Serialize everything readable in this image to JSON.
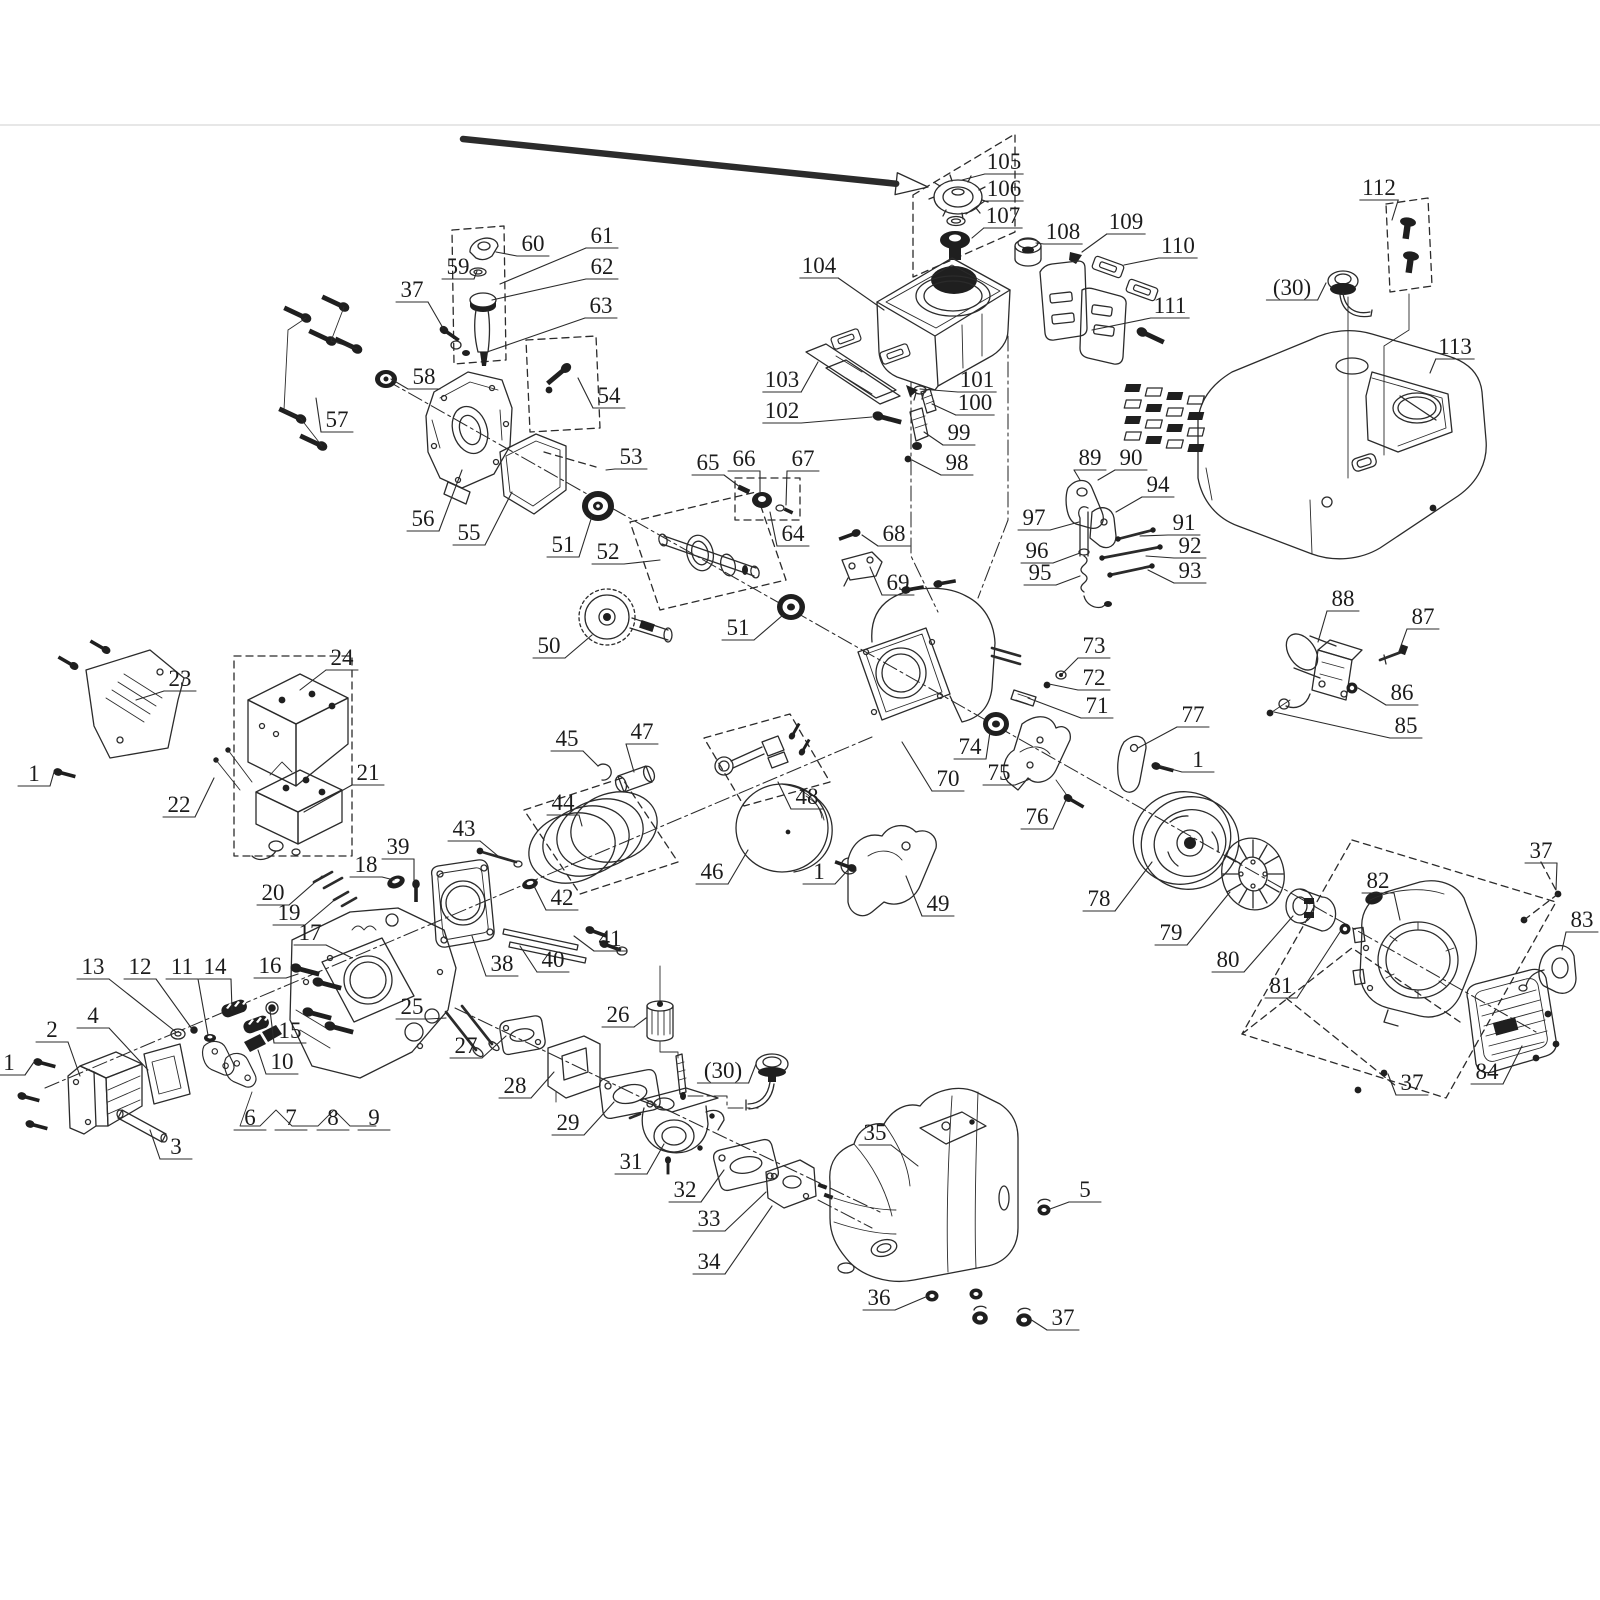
{
  "figure": {
    "type": "exploded-parts-diagram",
    "background": "#ffffff",
    "ink_color": "#2b2b2b",
    "label_color": "#1c1c1c",
    "label_font_size": 23,
    "page_rule_y": 125,
    "page_rule_color": "#e7e7e7"
  },
  "annotation_arrow": {
    "color": "#f14b4b",
    "x1": 463,
    "y1": 139,
    "x2": 928,
    "y2": 187
  },
  "callouts": [
    {
      "t": "105",
      "x": 1004,
      "y": 162,
      "lx": 962,
      "ly": 180
    },
    {
      "t": "106",
      "x": 1004,
      "y": 189,
      "lx": 966,
      "ly": 214
    },
    {
      "t": "107",
      "x": 1003,
      "y": 216,
      "lx": 972,
      "ly": 238
    },
    {
      "t": "108",
      "x": 1063,
      "y": 232,
      "lx": 1036,
      "ly": 243
    },
    {
      "t": "109",
      "x": 1126,
      "y": 222,
      "lx": 1082,
      "ly": 252
    },
    {
      "t": "110",
      "x": 1178,
      "y": 246,
      "lx": 1124,
      "ly": 265
    },
    {
      "t": "111",
      "x": 1170,
      "y": 306,
      "lx": 1092,
      "ly": 330
    },
    {
      "t": "104",
      "x": 819,
      "y": 266,
      "lx": 884,
      "ly": 310
    },
    {
      "t": "103",
      "x": 782,
      "y": 380,
      "lx": 818,
      "ly": 362
    },
    {
      "t": "102",
      "x": 782,
      "y": 411,
      "lx": 872,
      "ly": 417
    },
    {
      "t": "101",
      "x": 977,
      "y": 380,
      "lx": 920,
      "ly": 389
    },
    {
      "t": "100",
      "x": 975,
      "y": 403,
      "lx": 932,
      "ly": 404
    },
    {
      "t": "99",
      "x": 959,
      "y": 433,
      "lx": 924,
      "ly": 432
    },
    {
      "t": "98",
      "x": 957,
      "y": 463,
      "lx": 912,
      "ly": 460
    },
    {
      "t": "112",
      "x": 1379,
      "y": 188,
      "lx": 1392,
      "ly": 220
    },
    {
      "t": "(30)",
      "x": 1292,
      "y": 288,
      "lx": 1326,
      "ly": 283
    },
    {
      "t": "113",
      "x": 1455,
      "y": 347,
      "lx": 1430,
      "ly": 373
    },
    {
      "t": "60",
      "x": 533,
      "y": 244,
      "lx": 496,
      "ly": 252
    },
    {
      "t": "61",
      "x": 602,
      "y": 236,
      "lx": 500,
      "ly": 284
    },
    {
      "t": "59",
      "x": 458,
      "y": 267,
      "lx": 477,
      "ly": 271
    },
    {
      "t": "62",
      "x": 602,
      "y": 267,
      "lx": 492,
      "ly": 300
    },
    {
      "t": "37",
      "x": 412,
      "y": 290,
      "lx": 443,
      "ly": 328
    },
    {
      "t": "63",
      "x": 601,
      "y": 306,
      "lx": 487,
      "ly": 352
    },
    {
      "t": "58",
      "x": 424,
      "y": 377,
      "lx": 391,
      "ly": 379
    },
    {
      "t": "54",
      "x": 609,
      "y": 396,
      "lx": 578,
      "ly": 378
    },
    {
      "t": "57",
      "x": 337,
      "y": 420,
      "lx": 316,
      "ly": 398
    },
    {
      "t": "53",
      "x": 631,
      "y": 457,
      "lx": 606,
      "ly": 470
    },
    {
      "t": "56",
      "x": 423,
      "y": 519,
      "lx": 462,
      "ly": 470
    },
    {
      "t": "55",
      "x": 469,
      "y": 533,
      "lx": 512,
      "ly": 492
    },
    {
      "t": "51",
      "x": 563,
      "y": 545,
      "lx": 592,
      "ly": 516
    },
    {
      "t": "52",
      "x": 608,
      "y": 552,
      "lx": 660,
      "ly": 560
    },
    {
      "t": "65",
      "x": 708,
      "y": 463,
      "lx": 740,
      "ly": 487
    },
    {
      "t": "66",
      "x": 744,
      "y": 459,
      "lx": 760,
      "ly": 492
    },
    {
      "t": "67",
      "x": 803,
      "y": 459,
      "lx": 786,
      "ly": 505
    },
    {
      "t": "64",
      "x": 793,
      "y": 534,
      "lx": 770,
      "ly": 512
    },
    {
      "t": "68",
      "x": 894,
      "y": 534,
      "lx": 862,
      "ly": 535
    },
    {
      "t": "69",
      "x": 898,
      "y": 583,
      "lx": 870,
      "ly": 567
    },
    {
      "t": "50",
      "x": 549,
      "y": 646,
      "lx": 592,
      "ly": 635
    },
    {
      "t": "51",
      "x": 738,
      "y": 628,
      "lx": 783,
      "ly": 615
    },
    {
      "t": "89",
      "x": 1090,
      "y": 458,
      "lx": 1080,
      "ly": 480
    },
    {
      "t": "90",
      "x": 1131,
      "y": 458,
      "lx": 1098,
      "ly": 480
    },
    {
      "t": "94",
      "x": 1158,
      "y": 485,
      "lx": 1116,
      "ly": 512
    },
    {
      "t": "97",
      "x": 1034,
      "y": 518,
      "lx": 1079,
      "ly": 522
    },
    {
      "t": "91",
      "x": 1184,
      "y": 523,
      "lx": 1140,
      "ly": 536
    },
    {
      "t": "96",
      "x": 1037,
      "y": 551,
      "lx": 1080,
      "ly": 553
    },
    {
      "t": "92",
      "x": 1190,
      "y": 546,
      "lx": 1146,
      "ly": 556
    },
    {
      "t": "95",
      "x": 1040,
      "y": 573,
      "lx": 1080,
      "ly": 576
    },
    {
      "t": "93",
      "x": 1190,
      "y": 571,
      "lx": 1148,
      "ly": 570
    },
    {
      "t": "88",
      "x": 1343,
      "y": 599,
      "lx": 1318,
      "ly": 642
    },
    {
      "t": "87",
      "x": 1423,
      "y": 617,
      "lx": 1398,
      "ly": 654
    },
    {
      "t": "86",
      "x": 1402,
      "y": 693,
      "lx": 1358,
      "ly": 688
    },
    {
      "t": "85",
      "x": 1406,
      "y": 726,
      "lx": 1274,
      "ly": 712
    },
    {
      "t": "73",
      "x": 1094,
      "y": 646,
      "lx": 1062,
      "ly": 674
    },
    {
      "t": "72",
      "x": 1094,
      "y": 678,
      "lx": 1049,
      "ly": 684
    },
    {
      "t": "71",
      "x": 1097,
      "y": 706,
      "lx": 1028,
      "ly": 698
    },
    {
      "t": "77",
      "x": 1193,
      "y": 715,
      "lx": 1138,
      "ly": 748
    },
    {
      "t": "1",
      "x": 1198,
      "y": 760,
      "lx": 1160,
      "ly": 766
    },
    {
      "t": "74",
      "x": 970,
      "y": 747,
      "lx": 990,
      "ly": 732
    },
    {
      "t": "70",
      "x": 948,
      "y": 779,
      "lx": 902,
      "ly": 742
    },
    {
      "t": "75",
      "x": 999,
      "y": 773,
      "lx": 1030,
      "ly": 779
    },
    {
      "t": "76",
      "x": 1037,
      "y": 817,
      "lx": 1066,
      "ly": 800
    },
    {
      "t": "49",
      "x": 938,
      "y": 904,
      "lx": 906,
      "ly": 876
    },
    {
      "t": "1",
      "x": 819,
      "y": 872,
      "lx": 848,
      "ly": 870
    },
    {
      "t": "78",
      "x": 1099,
      "y": 899,
      "lx": 1152,
      "ly": 862
    },
    {
      "t": "79",
      "x": 1171,
      "y": 933,
      "lx": 1230,
      "ly": 892
    },
    {
      "t": "80",
      "x": 1228,
      "y": 960,
      "lx": 1293,
      "ly": 916
    },
    {
      "t": "81",
      "x": 1281,
      "y": 986,
      "lx": 1340,
      "ly": 932
    },
    {
      "t": "82",
      "x": 1378,
      "y": 881,
      "lx": 1400,
      "ly": 920
    },
    {
      "t": "37",
      "x": 1541,
      "y": 851,
      "lx": 1556,
      "ly": 890
    },
    {
      "t": "83",
      "x": 1582,
      "y": 920,
      "lx": 1562,
      "ly": 950
    },
    {
      "t": "84",
      "x": 1487,
      "y": 1072,
      "lx": 1522,
      "ly": 1046
    },
    {
      "t": "37",
      "x": 1412,
      "y": 1083,
      "lx": 1388,
      "ly": 1074
    },
    {
      "t": "23",
      "x": 180,
      "y": 679,
      "lx": 136,
      "ly": 700
    },
    {
      "t": "24",
      "x": 342,
      "y": 658,
      "lx": 300,
      "ly": 690
    },
    {
      "t": "1",
      "x": 34,
      "y": 774,
      "lx": 54,
      "ly": 772
    },
    {
      "t": "22",
      "x": 179,
      "y": 805,
      "lx": 214,
      "ly": 778
    },
    {
      "t": "21",
      "x": 368,
      "y": 773,
      "lx": 304,
      "ly": 812
    },
    {
      "t": "39",
      "x": 398,
      "y": 847,
      "lx": 414,
      "ly": 880
    },
    {
      "t": "18",
      "x": 366,
      "y": 865,
      "lx": 394,
      "ly": 880
    },
    {
      "t": "20",
      "x": 273,
      "y": 893,
      "lx": 322,
      "ly": 876
    },
    {
      "t": "19",
      "x": 289,
      "y": 913,
      "lx": 338,
      "ly": 897
    },
    {
      "t": "17",
      "x": 310,
      "y": 933,
      "lx": 352,
      "ly": 958
    },
    {
      "t": "16",
      "x": 270,
      "y": 966,
      "lx": 298,
      "ly": 974
    },
    {
      "t": "25",
      "x": 412,
      "y": 1007,
      "lx": 446,
      "ly": 1018
    },
    {
      "t": "38",
      "x": 502,
      "y": 964,
      "lx": 472,
      "ly": 936
    },
    {
      "t": "45",
      "x": 567,
      "y": 739,
      "lx": 598,
      "ly": 766
    },
    {
      "t": "47",
      "x": 642,
      "y": 732,
      "lx": 634,
      "ly": 772
    },
    {
      "t": "44",
      "x": 563,
      "y": 803,
      "lx": 582,
      "ly": 826
    },
    {
      "t": "43",
      "x": 464,
      "y": 829,
      "lx": 498,
      "ly": 856
    },
    {
      "t": "48",
      "x": 807,
      "y": 797,
      "lx": 778,
      "ly": 782
    },
    {
      "t": "46",
      "x": 712,
      "y": 872,
      "lx": 748,
      "ly": 850
    },
    {
      "t": "42",
      "x": 562,
      "y": 898,
      "lx": 534,
      "ly": 886
    },
    {
      "t": "41",
      "x": 610,
      "y": 939,
      "lx": 574,
      "ly": 936
    },
    {
      "t": "40",
      "x": 553,
      "y": 960,
      "lx": 520,
      "ly": 946
    },
    {
      "t": "13",
      "x": 93,
      "y": 967,
      "lx": 176,
      "ly": 1032
    },
    {
      "t": "12",
      "x": 140,
      "y": 967,
      "lx": 192,
      "ly": 1029
    },
    {
      "t": "11",
      "x": 182,
      "y": 967,
      "lx": 208,
      "ly": 1035
    },
    {
      "t": "14",
      "x": 215,
      "y": 967,
      "lx": 232,
      "ly": 1010
    },
    {
      "t": "15",
      "x": 290,
      "y": 1031,
      "lx": 270,
      "ly": 1010
    },
    {
      "t": "4",
      "x": 93,
      "y": 1016,
      "lx": 148,
      "ly": 1070
    },
    {
      "t": "2",
      "x": 52,
      "y": 1030,
      "lx": 80,
      "ly": 1076
    },
    {
      "t": "1",
      "x": 9,
      "y": 1063,
      "lx": 34,
      "ly": 1062
    },
    {
      "t": "10",
      "x": 282,
      "y": 1062,
      "lx": 258,
      "ly": 1050
    },
    {
      "t": "6",
      "x": 250,
      "y": 1118
    },
    {
      "t": "7",
      "x": 291,
      "y": 1118
    },
    {
      "t": "8",
      "x": 333,
      "y": 1118
    },
    {
      "t": "9",
      "x": 374,
      "y": 1118
    },
    {
      "t": "3",
      "x": 176,
      "y": 1147,
      "lx": 150,
      "ly": 1130
    },
    {
      "t": "26",
      "x": 618,
      "y": 1015,
      "lx": 646,
      "ly": 1018
    },
    {
      "t": "27",
      "x": 466,
      "y": 1046,
      "lx": 506,
      "ly": 1036
    },
    {
      "t": "28",
      "x": 515,
      "y": 1086,
      "lx": 554,
      "ly": 1072
    },
    {
      "t": "(30)",
      "x": 723,
      "y": 1071,
      "lx": 756,
      "ly": 1064
    },
    {
      "t": "29",
      "x": 568,
      "y": 1123,
      "lx": 614,
      "ly": 1102
    },
    {
      "t": "31",
      "x": 631,
      "y": 1162,
      "lx": 664,
      "ly": 1144
    },
    {
      "t": "32",
      "x": 685,
      "y": 1190,
      "lx": 724,
      "ly": 1170
    },
    {
      "t": "33",
      "x": 709,
      "y": 1219,
      "lx": 766,
      "ly": 1192
    },
    {
      "t": "34",
      "x": 709,
      "y": 1262,
      "lx": 772,
      "ly": 1206
    },
    {
      "t": "35",
      "x": 875,
      "y": 1133,
      "lx": 918,
      "ly": 1166
    },
    {
      "t": "5",
      "x": 1085,
      "y": 1190,
      "lx": 1050,
      "ly": 1209
    },
    {
      "t": "36",
      "x": 879,
      "y": 1298,
      "lx": 928,
      "ly": 1296
    },
    {
      "t": "37",
      "x": 1063,
      "y": 1318,
      "lx": 1030,
      "ly": 1319
    }
  ]
}
